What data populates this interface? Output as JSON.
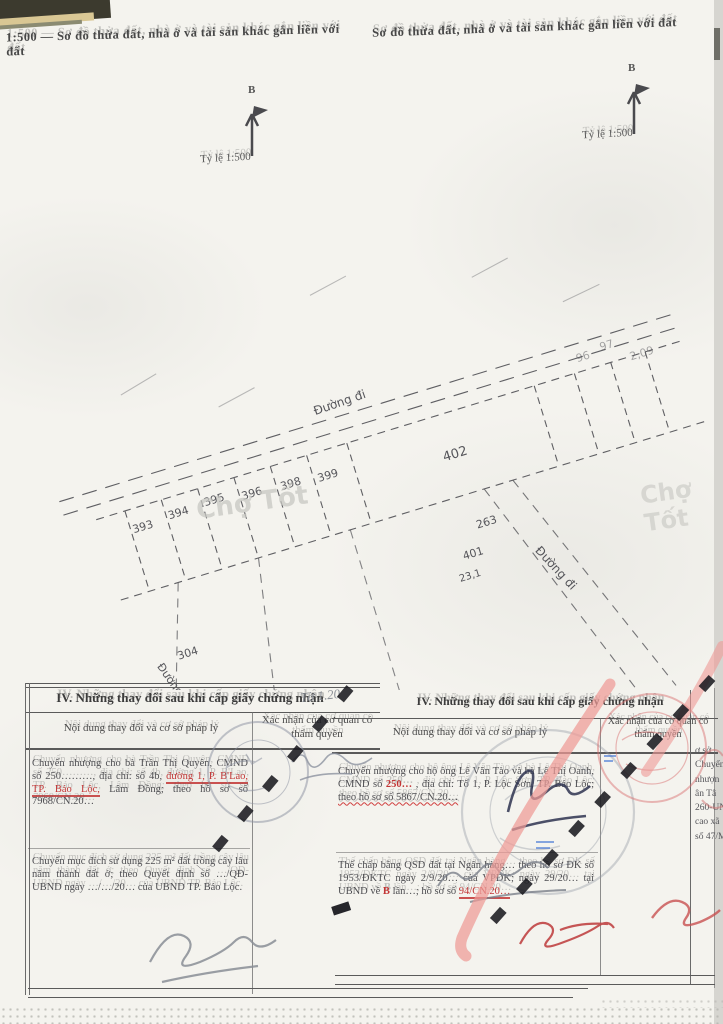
{
  "page": {
    "header_left": "1:500 — Sơ đồ thửa đất, nhà ở và tài sản khác gắn liền với đất",
    "header_right": "Sơ đồ thửa đất, nhà ở và tài sản khác gắn liền với đất",
    "colors": {
      "paper": "#f4f3ee",
      "ink": "#4e4e52",
      "red_accent": "#c23535",
      "pink_stroke": "#ef9a96",
      "dark_stroke": "#1a1a20",
      "stamp_gray": "#8a90a0"
    }
  },
  "map": {
    "north_letter": "B",
    "scale_label": "Tỷ lệ 1:500",
    "road_top": "Đường đi",
    "road_mid": "Đường đi",
    "road_left": "Đường",
    "watermark": "Chợ Tốt",
    "parcels": {
      "p393": "393",
      "p394": "394",
      "p395": "395",
      "p396": "396",
      "p398": "398",
      "p399": "399",
      "p402": "402",
      "p263": "263",
      "p401": "401",
      "a231": "23,1",
      "p304": "304",
      "g96": "96",
      "g97": "97",
      "g209": "2,09"
    }
  },
  "section": {
    "title": "IV. Những thay đổi sau khi cấp giấy chứng nhận",
    "col_content": "Nội dung thay đổi và cơ sở pháp lý",
    "col_confirm": "Xác nhận của cơ quan có thẩm quyền"
  },
  "left_table": {
    "r1a": "Chuyển nhượng cho bà Trần Thị Quyên, CMND số 250………, địa chỉ: số 4b,",
    "r1red": "đường 1, P. B'Lao, TP. Bảo Lộc,",
    "r1b": "Lâm Đồng; theo hồ sơ số 7968/CN.20…",
    "r2": "Chuyển mục đích sử dụng 225 m² đất trồng cây lâu năm thành đất ở; theo Quyết định số …/QĐ-UBND ngày …/…/20… của UBND TP. Bảo Lộc.",
    "note": "Tờ 1.20",
    "script": "19/10"
  },
  "right_table": {
    "r1a": "Chuyển nhượng cho hộ ông Lê Văn Tào và bà Lê Thị Oanh, CMND số",
    "r1red": "250…",
    "r1b": ", địa chỉ: Tổ 1, P. Lộc Sơn, TP. Bảo Lộc;",
    "r1wavy": "theo hồ sơ số 5867/CN.20…",
    "r2a": "Thế chấp bằng QSD đất tại Ngân hàng… theo hồ sơ ĐK số 1953/ĐKTC ngày 2/9/20… của VPĐK; ngày 29/20… tại UBND về",
    "r2red": "B",
    "r2b": " lần…; hồ sơ số",
    "r2red2": "94/CN.20…"
  },
  "edge_fragments": {
    "f1": "ơ sở",
    "f2": "Chuyển",
    "f3": "nhượn",
    "f4": "ân Tâ",
    "f5": "260-UN",
    "f6": "cao xã",
    "f7": "số 47/M"
  }
}
